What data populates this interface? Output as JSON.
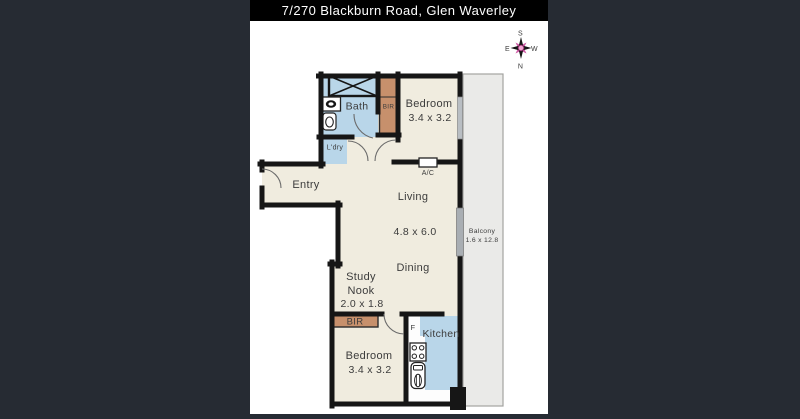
{
  "title": "7/270 Blackburn Road, Glen Waverley",
  "compass": {
    "top": "S",
    "left": "E",
    "right": "W",
    "bottom": "N"
  },
  "labels": {
    "bath": "Bath",
    "bir_top": "BIR",
    "bedroom_top": "Bedroom",
    "bedroom_top_dims": "3.4 x 3.2",
    "laundry": "L'dry",
    "entry": "Entry",
    "ac": "A/C",
    "living": "Living",
    "living_dining_dims": "4.8 x 6.0",
    "dining": "Dining",
    "balcony": "Balcony",
    "balcony_dims": "1.6 x 12.8",
    "study_nook_line1": "Study",
    "study_nook_line2": "Nook",
    "study_nook_dims": "2.0 x 1.8",
    "bir_bottom": "BIR",
    "bedroom_bottom": "Bedroom",
    "bedroom_bottom_dims": "3.4 x 3.2",
    "fridge": "F",
    "kitchen": "Kitchen"
  },
  "colors": {
    "page_background": "#262b33",
    "title_bar": "#000000",
    "title_text": "#ffffff",
    "plan_background": "#ffffff",
    "floor": "#f0ecdf",
    "wet_area": "#b9d6e9",
    "wardrobe": "#c7906c",
    "balcony": "#eaeae8",
    "wall": "#161616",
    "label_text": "#3c3c3c",
    "compass_accent": "#cf5ca6"
  }
}
